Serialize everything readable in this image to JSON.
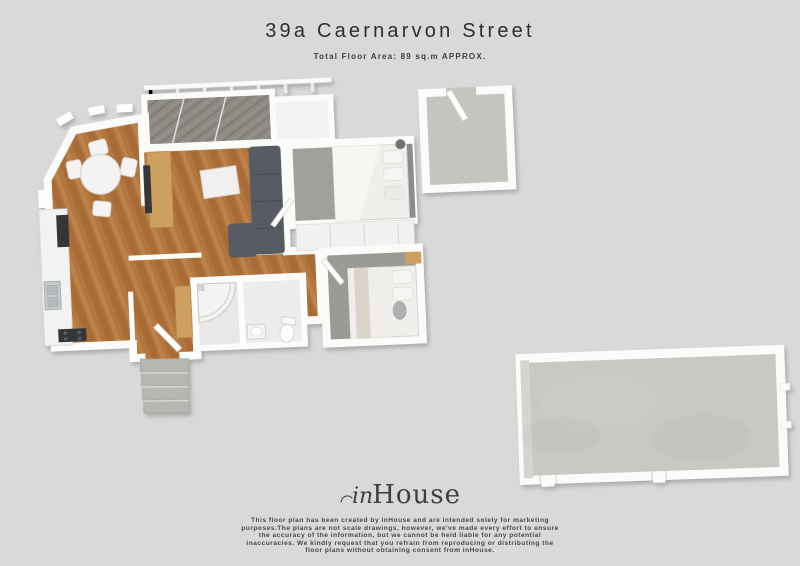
{
  "header": {
    "title": "39a Caernarvon Street",
    "subtitle": "Total Floor Area: 89 sq.m APPROX."
  },
  "footer": {
    "logo_prefix": "in",
    "logo_suffix": "House",
    "disclaimer_lines": [
      "This floor plan has been created by inHouse and are intended solely for marketing",
      "purposes.The plans are not scale drawings, however, we've made every effort to ensure",
      "the accuracy of the information, but we cannot be held liable for any potential",
      "inaccuracies. We kindly request that you refrain from reproducing or distributing the",
      "floor plans without obtaining consent from inHouse."
    ]
  },
  "floorplan": {
    "colors": {
      "background": "#d9d9d9",
      "wall": "#fbfbfa",
      "wall_edge": "#c4c2c0",
      "wood": "#b3763f",
      "wood_dark": "#a2642f",
      "wood_light": "#c08a52",
      "carpet": "#a2a09c",
      "carpet2": "#9c9a96",
      "tile": "#c6c4c1",
      "concrete": "#cac8c4",
      "deck": "#8e8a84",
      "deck_dark": "#7c7872",
      "sofa": "#575c64",
      "timber": "#cda05f",
      "steps": "#b6b6b3",
      "appliance_dark": "#35363a",
      "sink_metal": "#c7cbcd",
      "bedding": "#f1efec",
      "furniture_white": "#f3f2f0",
      "roof_white": "#f2f2f1"
    }
  }
}
